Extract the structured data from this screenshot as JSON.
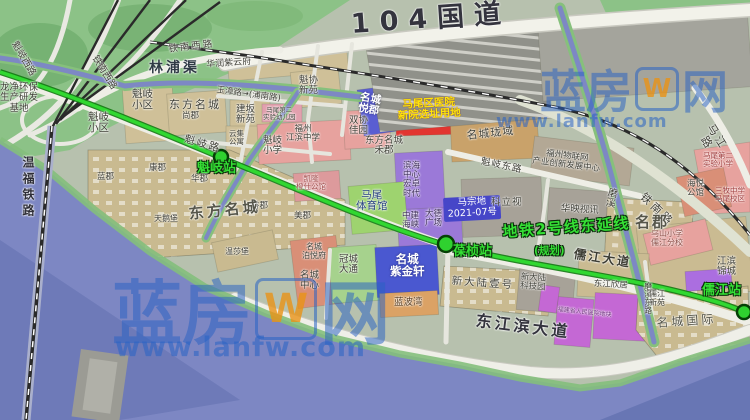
{
  "watermark": {
    "brand_left": "蓝房",
    "brand_right": "网",
    "logo_letter": "W",
    "url": "www.lanfw.com"
  },
  "metro": {
    "line_label": "地铁2号线东延线",
    "planning": "(规划)",
    "stations": {
      "kuiqi": "魁岐站",
      "baozhen": "葆桢站",
      "rujiang": "儒江站"
    }
  },
  "roads": {
    "g104": "104国道",
    "tienanxi_a": "铁南西路",
    "tienanxi_b": "铁南西路",
    "kuiqixi": "魁岐西路",
    "kuiqi": "魁岐路",
    "kuiqidong": "魁岐东路",
    "yuzhang": "玉漳路→(浦南路)",
    "tienan": "铁南路",
    "majiang": "马江路",
    "rujiangdadao": "儒江大道",
    "dongjiangbin": "东江滨大道",
    "moxidong": "磨溪东路"
  },
  "waterways": {
    "linpuqu": "林浦渠",
    "moxi": "磨溪",
    "wenfu_railway": "温福铁路"
  },
  "places": {
    "longjing": "龙净环保\n生产研发\n基地",
    "huarun": "华润紫云府",
    "kuixie": "魁协\n新苑",
    "jianban": "建坂\n新苑",
    "kuiqi_xq_a": "魁岐\n小区",
    "kuiqi_xq_b": "魁岐\n小区",
    "dfmc_top": "东方名城",
    "shangjun": "尚郡",
    "yunji": "云集\n公寓",
    "kuiqi_school": "魁岐\n小学",
    "jiangbin_school": "福州\n江滨中学",
    "kinder": "马尾第二\n实验幼儿园",
    "shuangxie": "双协\n佳园",
    "yuejun": "名城\n悦郡",
    "hospital": "马尾区医院\n新院选址用地",
    "longyu": "名城珑域",
    "iot": "福州物联网\n产业创新发展中心",
    "dfmc_he": "东方名城\n禾郡",
    "binhai": "滨海\n中心\n宏卓\n时代",
    "stadium": "马尾\n体育馆",
    "zhongjian": "中建\n海峡",
    "dade": "大德\n广场",
    "mazongdi": "马宗地\n2021-07号",
    "kelishi": "科立视",
    "huaying": "华映视讯",
    "mingjun": "名郡",
    "exp_school": "马尾第二\n实验小学",
    "haiyue": "海悦\n公馆",
    "sanmu": "三牧中学\n马尾校区",
    "wushan": "乌山小学\n儒江分校",
    "jiangbinjincheng": "江滨\n锦城",
    "lanjun": "蓝郡",
    "kangjun": "康郡",
    "huajun": "华郡",
    "xiangjun": "香郡",
    "meijun": "美郡",
    "dfmc_big": "东方名城",
    "tianebao": "天鹅堡",
    "wenshabao": "温莎堡",
    "kailong": "凯隆\n橙仕公馆",
    "boyuefu": "名城\n泊悦府",
    "mc_center": "名城\n中心",
    "guancheng": "冠城\n大通",
    "zijinxuan": "名城\n紫金轩",
    "lanbowan": "蓝波湾",
    "xindalu1": "新大陆壹号",
    "xindalu_tech": "新大陆\n科技园",
    "dj_xinju": "东江欣居",
    "rujiang_xy": "儒江\n新苑",
    "mc_intl": "名城国际",
    "hospital_plot": "福建省人民医院地块"
  },
  "colors": {
    "water": "#7d87c3",
    "metro_green": "#2fd12f",
    "hospital_red": "#e23530",
    "hospital_text": "#ffe60a",
    "watermark_blue": "#2862c4",
    "parcel_khaki": "#c9ba90",
    "parcel_pink": "#e7a29e",
    "parcel_purple": "#9b79d8"
  }
}
